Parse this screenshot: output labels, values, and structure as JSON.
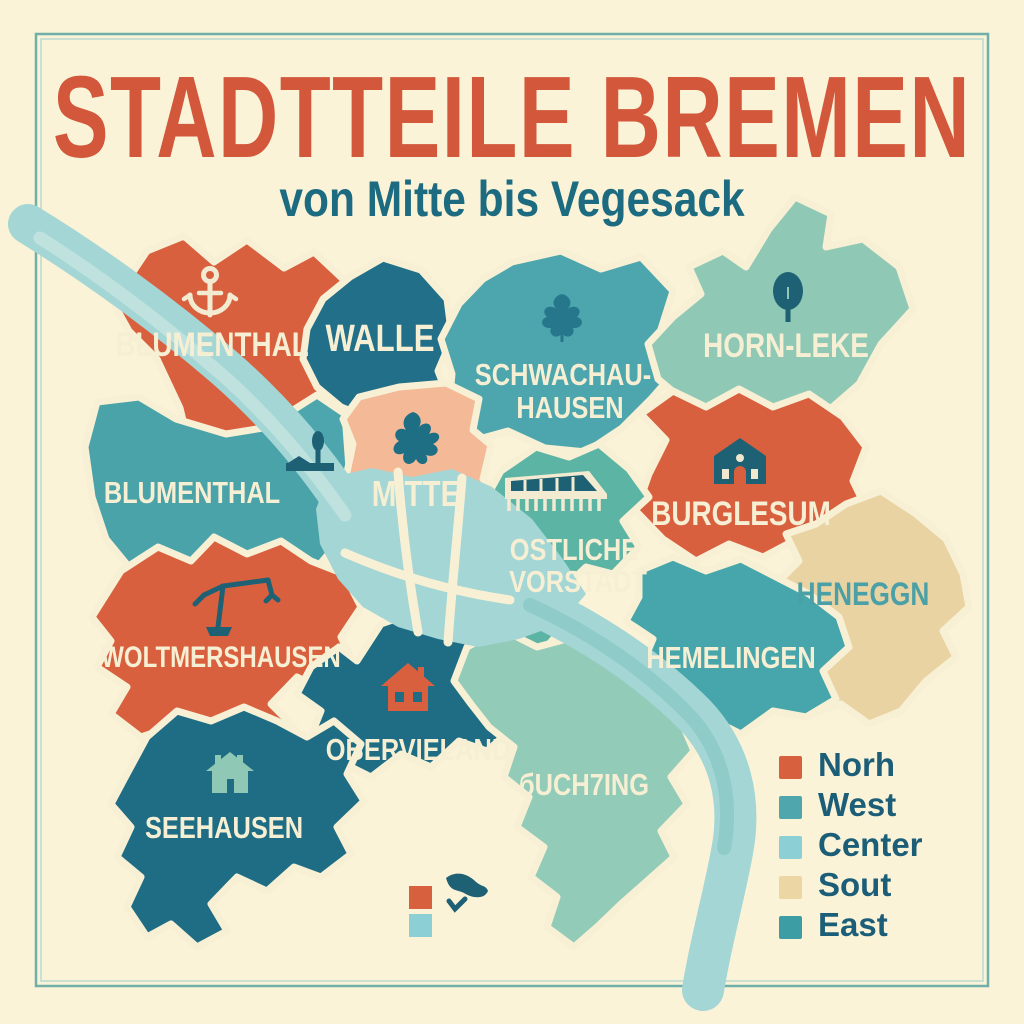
{
  "poster": {
    "title": "STADTTEILE BREMEN",
    "subtitle": "von Mitte bis Vegesack"
  },
  "colors": {
    "background": "#faf3d8",
    "border": "#6fafa7",
    "title": "#d2573b",
    "subtitle": "#1d6b80",
    "river": "#a3d6d5",
    "label_cream": "#f7efd3",
    "label_teal": "#4b9fa6"
  },
  "regions": [
    {
      "id": "blumenthal-north",
      "label": "BLUMENTHAL",
      "icon": "anchor-icon",
      "color": "#d8603e"
    },
    {
      "id": "walle",
      "label": "WALLE",
      "color": "#216f88"
    },
    {
      "id": "schwachhausen",
      "label_line1": "SCHWACHAU-",
      "label_line2": "HAUSEN",
      "icon": "leaf-icon",
      "color": "#4da6ad"
    },
    {
      "id": "horn-leke",
      "label": "HORN-LEKE",
      "icon": "tree-icon",
      "color": "#8fc9b5"
    },
    {
      "id": "blumenthal-west",
      "label": "BLUMENTHAL",
      "color": "#4aa3a9"
    },
    {
      "id": "mitte",
      "label": "MITTE",
      "icon": "splat-icon",
      "color": "#f4b997"
    },
    {
      "id": "burglesum",
      "label": "BURGLESUM",
      "icon": "church-icon",
      "color": "#d8603e"
    },
    {
      "id": "heneggn",
      "label": "HENEGGN",
      "color": "#e9d3a2"
    },
    {
      "id": "ostliche-vorstadt",
      "label_line1": "OSTLICHE",
      "label_line2": "VORSTADT",
      "icon": "bridge-building-icon",
      "color": "#5cb4a4"
    },
    {
      "id": "hemelingen",
      "label": "HEMELINGEN",
      "color": "#46a6ab"
    },
    {
      "id": "woltmershausen",
      "label": "WOLTMERSHAUSEN",
      "icon": "crane-icon",
      "color": "#d8603e"
    },
    {
      "id": "obervieland",
      "label": "OBERVIELAND",
      "icon": "house-icon",
      "color": "#1e6d84"
    },
    {
      "id": "seehausen",
      "label": "SEEHAUSEN",
      "icon": "house-icon",
      "color": "#1e6d84"
    },
    {
      "id": "buchting",
      "label": "бUCH7ING",
      "color": "#92cbb7"
    },
    {
      "id": "findorff-area",
      "icon": "monument-icon",
      "color": "#4da6ad"
    }
  ],
  "legend": {
    "items": [
      {
        "label": "Norh",
        "color": "#d7603e"
      },
      {
        "label": "West",
        "color": "#4fa6ac"
      },
      {
        "label": "Center",
        "color": "#8ccfd4"
      },
      {
        "label": "Sout",
        "color": "#ecd6a4"
      },
      {
        "label": "East",
        "color": "#3d9da5"
      }
    ]
  }
}
